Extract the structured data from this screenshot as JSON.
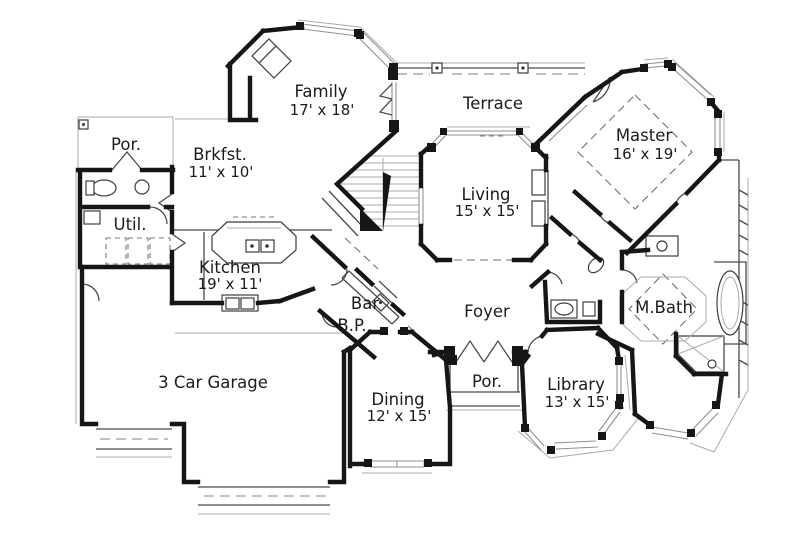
{
  "meta": {
    "type": "architectural-floor-plan",
    "background_color": "#ffffff",
    "wall_color": "#161616",
    "window_line_color": "#8f8f8f",
    "text_color": "#1b1b1b"
  },
  "rooms": {
    "family": {
      "label": "Family",
      "dims": "17' x 18'"
    },
    "terrace": {
      "label": "Terrace",
      "dims": ""
    },
    "master": {
      "label": "Master",
      "dims": "16' x 19'"
    },
    "por_upper": {
      "label": "Por.",
      "dims": ""
    },
    "brkfst": {
      "label": "Brkfst.",
      "dims": "11' x 10'"
    },
    "util": {
      "label": "Util.",
      "dims": ""
    },
    "living": {
      "label": "Living",
      "dims": "15' x 15'"
    },
    "kitchen": {
      "label": "Kitchen",
      "dims": "19' x 11'"
    },
    "bar": {
      "label": "Bar",
      "dims": ""
    },
    "bp": {
      "label": "B.P.",
      "dims": ""
    },
    "foyer": {
      "label": "Foyer",
      "dims": ""
    },
    "mbath": {
      "label": "M.Bath",
      "dims": ""
    },
    "garage": {
      "label": "3 Car Garage",
      "dims": ""
    },
    "dining": {
      "label": "Dining",
      "dims": "12' x 15'"
    },
    "por_lower": {
      "label": "Por.",
      "dims": ""
    },
    "library": {
      "label": "Library",
      "dims": "13' x 15'"
    }
  }
}
